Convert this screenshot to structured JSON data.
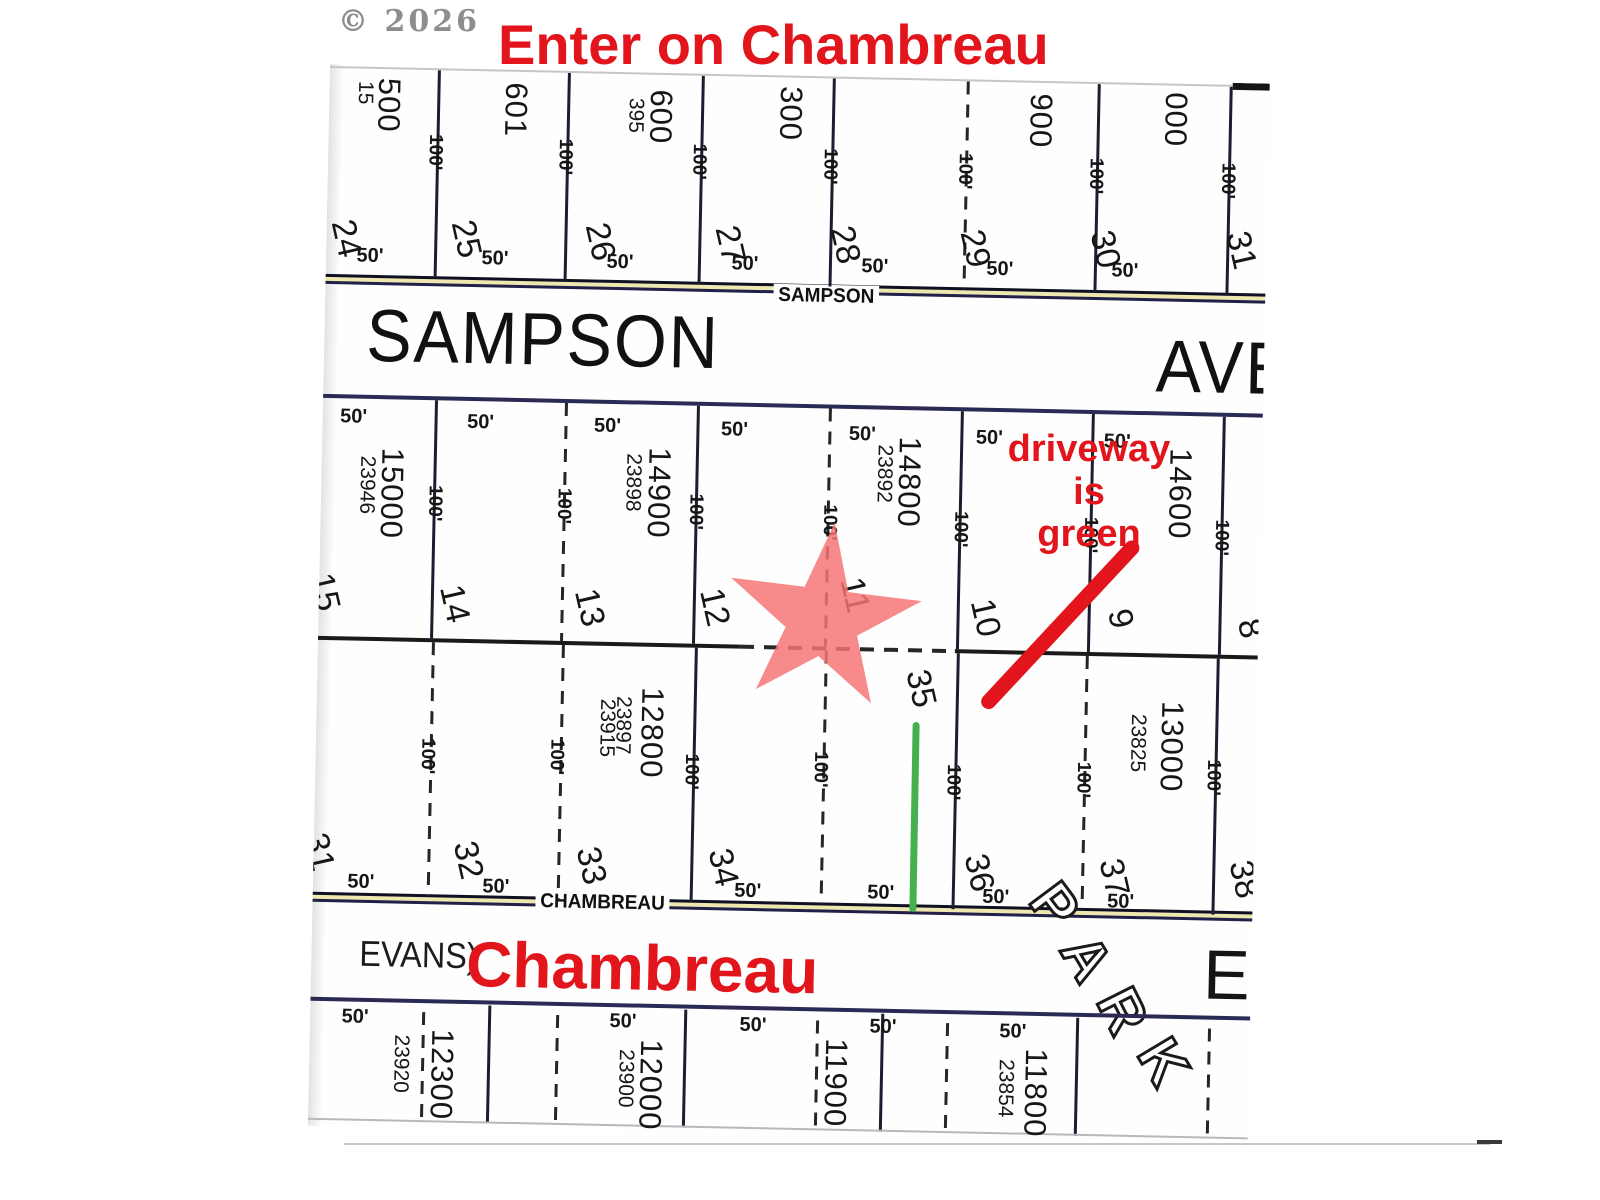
{
  "colors": {
    "annotation_red": "#e1151b",
    "star_fill": "#f57373",
    "driveway_green": "#45b14e",
    "street_fill": "#eee7b0"
  },
  "watermark": "© 2026",
  "annotations": {
    "top_note": "Enter on Chambreau",
    "driveway_note_line1": "driveway is",
    "driveway_note_line2": "green",
    "star_icon": "location-star",
    "arrow_icon": "red-arrow",
    "driveway_line_icon": "green-driveway-line"
  },
  "streets": {
    "sampson": {
      "small": "SAMPSON",
      "large": "SAMPSON",
      "ave": "AVE"
    },
    "chambreau": {
      "small": "CHAMBREAU",
      "evans": "EVANS)",
      "large": "Chambreau",
      "e": "E",
      "park_letters": [
        "P",
        "A",
        "R",
        "K"
      ]
    }
  },
  "plat": {
    "vlines": [
      {
        "x": 108,
        "y1": 4,
        "y2": 212
      },
      {
        "x": 238,
        "y1": 4,
        "y2": 212
      },
      {
        "x": 372,
        "y1": 4,
        "y2": 212
      },
      {
        "x": 503,
        "y1": 4,
        "y2": 212
      },
      {
        "x": 637,
        "y1": 4,
        "y2": 212,
        "d": 1
      },
      {
        "x": 768,
        "y1": 4,
        "y2": 212
      },
      {
        "x": 900,
        "y1": 4,
        "y2": 212
      },
      {
        "x": 112,
        "y1": 334,
        "y2": 572
      },
      {
        "x": 242,
        "y1": 334,
        "y2": 572,
        "d": 1
      },
      {
        "x": 374,
        "y1": 334,
        "y2": 572
      },
      {
        "x": 506,
        "y1": 334,
        "y2": 572,
        "d": 1
      },
      {
        "x": 638,
        "y1": 334,
        "y2": 572
      },
      {
        "x": 769,
        "y1": 334,
        "y2": 572
      },
      {
        "x": 900,
        "y1": 334,
        "y2": 572
      },
      {
        "x": 114,
        "y1": 576,
        "y2": 830,
        "d": 1
      },
      {
        "x": 244,
        "y1": 576,
        "y2": 830,
        "d": 1
      },
      {
        "x": 377,
        "y1": 576,
        "y2": 830
      },
      {
        "x": 507,
        "y1": 576,
        "y2": 830,
        "d": 1
      },
      {
        "x": 639,
        "y1": 576,
        "y2": 832
      },
      {
        "x": 768,
        "y1": 576,
        "y2": 830,
        "d": 1
      },
      {
        "x": 899,
        "y1": 576,
        "y2": 832
      },
      {
        "x": 112,
        "y1": 946,
        "y2": 1052,
        "d": 1
      },
      {
        "x": 178,
        "y1": 938,
        "y2": 1056
      },
      {
        "x": 246,
        "y1": 946,
        "y2": 1052,
        "d": 1
      },
      {
        "x": 374,
        "y1": 938,
        "y2": 1056
      },
      {
        "x": 506,
        "y1": 946,
        "y2": 1052,
        "d": 1
      },
      {
        "x": 571,
        "y1": 938,
        "y2": 1056
      },
      {
        "x": 636,
        "y1": 946,
        "y2": 1052,
        "d": 1
      },
      {
        "x": 766,
        "y1": 938,
        "y2": 1056
      },
      {
        "x": 898,
        "y1": 946,
        "y2": 1052,
        "d": 1
      }
    ],
    "hlines": [
      {
        "x": 0,
        "y": 2,
        "w": 940,
        "h": 2,
        "c": "#c6c6c6"
      },
      {
        "x": 903,
        "y": 0,
        "w": 37,
        "h": 7,
        "c": "#151515"
      },
      {
        "x": 0,
        "y": 330,
        "w": 940,
        "h": 4,
        "c": "#2a2a55"
      },
      {
        "x": 0,
        "y": 572,
        "w": 422,
        "h": 4,
        "c": "#1a1a1a"
      },
      {
        "x": 422,
        "y": 572,
        "w": 217,
        "h": 4,
        "c": "#1a1a1a",
        "d": 1
      },
      {
        "x": 637,
        "y": 572,
        "w": 303,
        "h": 4,
        "c": "#1a1a1a"
      },
      {
        "x": 0,
        "y": 933,
        "w": 940,
        "h": 4,
        "c": "#2a2a55"
      },
      {
        "x": 0,
        "y": 1054,
        "w": 940,
        "h": 2,
        "c": "#b8b8b8"
      }
    ],
    "labels": [
      {
        "t": "15",
        "x": 36,
        "y": 28,
        "k": "addr-sm"
      },
      {
        "t": "500",
        "x": 60,
        "y": 40,
        "k": "addr"
      },
      {
        "t": "601",
        "x": 187,
        "y": 42,
        "k": "addr"
      },
      {
        "t": "395",
        "x": 307,
        "y": 45,
        "k": "addr-sm"
      },
      {
        "t": "600",
        "x": 332,
        "y": 46,
        "k": "addr"
      },
      {
        "t": "300",
        "x": 462,
        "y": 40,
        "k": "addr"
      },
      {
        "t": "900",
        "x": 712,
        "y": 42,
        "k": "addr"
      },
      {
        "t": "000",
        "x": 847,
        "y": 38,
        "k": "addr"
      },
      {
        "t": "100'",
        "x": 107,
        "y": 86,
        "k": "d100"
      },
      {
        "t": "100'",
        "x": 237,
        "y": 88,
        "k": "d100"
      },
      {
        "t": "100'",
        "x": 371,
        "y": 90,
        "k": "d100"
      },
      {
        "t": "100'",
        "x": 502,
        "y": 92,
        "k": "d100"
      },
      {
        "t": "100'",
        "x": 637,
        "y": 94,
        "k": "d100"
      },
      {
        "t": "100'",
        "x": 768,
        "y": 96,
        "k": "d100"
      },
      {
        "t": "100'",
        "x": 900,
        "y": 98,
        "k": "d100"
      },
      {
        "t": "24",
        "x": 20,
        "y": 174,
        "k": "lot"
      },
      {
        "t": "25",
        "x": 140,
        "y": 172,
        "k": "lot"
      },
      {
        "t": "26",
        "x": 274,
        "y": 172,
        "k": "lot"
      },
      {
        "t": "27",
        "x": 404,
        "y": 172,
        "k": "lot"
      },
      {
        "t": "28",
        "x": 519,
        "y": 170,
        "k": "lot"
      },
      {
        "t": "29",
        "x": 649,
        "y": 171,
        "k": "lot"
      },
      {
        "t": "30",
        "x": 779,
        "y": 169,
        "k": "lot"
      },
      {
        "t": "31",
        "x": 915,
        "y": 167,
        "k": "lot"
      },
      {
        "t": "50'",
        "x": 44,
        "y": 191,
        "k": "d50"
      },
      {
        "t": "50'",
        "x": 169,
        "y": 191,
        "k": "d50"
      },
      {
        "t": "50'",
        "x": 294,
        "y": 192,
        "k": "d50"
      },
      {
        "t": "50'",
        "x": 419,
        "y": 191,
        "k": "d50"
      },
      {
        "t": "50'",
        "x": 549,
        "y": 191,
        "k": "d50"
      },
      {
        "t": "50'",
        "x": 674,
        "y": 191,
        "k": "d50"
      },
      {
        "t": "50'",
        "x": 799,
        "y": 190,
        "k": "d50"
      },
      {
        "t": "50'",
        "x": 31,
        "y": 352,
        "k": "d50"
      },
      {
        "t": "50'",
        "x": 158,
        "y": 355,
        "k": "d50"
      },
      {
        "t": "50'",
        "x": 285,
        "y": 356,
        "k": "d50"
      },
      {
        "t": "50'",
        "x": 412,
        "y": 357,
        "k": "d50"
      },
      {
        "t": "50'",
        "x": 540,
        "y": 359,
        "k": "d50"
      },
      {
        "t": "50'",
        "x": 667,
        "y": 360,
        "k": "d50"
      },
      {
        "t": "50'",
        "x": 795,
        "y": 361,
        "k": "d50"
      },
      {
        "t": "23946",
        "x": 46,
        "y": 420,
        "k": "addr-sm"
      },
      {
        "t": "15000",
        "x": 71,
        "y": 428,
        "k": "addr"
      },
      {
        "t": "23898",
        "x": 312,
        "y": 412,
        "k": "addr-sm"
      },
      {
        "t": "14900",
        "x": 338,
        "y": 422,
        "k": "addr"
      },
      {
        "t": "23892",
        "x": 563,
        "y": 398,
        "k": "addr-sm"
      },
      {
        "t": "14800",
        "x": 588,
        "y": 406,
        "k": "addr"
      },
      {
        "t": "14600",
        "x": 859,
        "y": 412,
        "k": "addr"
      },
      {
        "t": "100'",
        "x": 114,
        "y": 437,
        "k": "d100"
      },
      {
        "t": "100'",
        "x": 243,
        "y": 437,
        "k": "d100"
      },
      {
        "t": "100'",
        "x": 375,
        "y": 440,
        "k": "d100"
      },
      {
        "t": "100'",
        "x": 509,
        "y": 448,
        "k": "d100"
      },
      {
        "t": "100'",
        "x": 640,
        "y": 452,
        "k": "d100"
      },
      {
        "t": "100'",
        "x": 770,
        "y": 455,
        "k": "d100"
      },
      {
        "t": "100'",
        "x": 901,
        "y": 455,
        "k": "d100"
      },
      {
        "t": "15",
        "x": 6,
        "y": 528,
        "k": "lot"
      },
      {
        "t": "14",
        "x": 136,
        "y": 537,
        "k": "lot"
      },
      {
        "t": "13",
        "x": 271,
        "y": 538,
        "k": "lot"
      },
      {
        "t": "12",
        "x": 396,
        "y": 535,
        "k": "lot"
      },
      {
        "t": "11",
        "x": 536,
        "y": 520,
        "k": "lot"
      },
      {
        "t": "10",
        "x": 667,
        "y": 540,
        "k": "lot"
      },
      {
        "t": "9",
        "x": 802,
        "y": 538,
        "k": "lot"
      },
      {
        "t": "8",
        "x": 932,
        "y": 545,
        "k": "lot"
      },
      {
        "t": "23915",
        "x": 291,
        "y": 658,
        "k": "addr-sm"
      },
      {
        "t": "23897",
        "x": 307,
        "y": 655,
        "k": "addr-sm"
      },
      {
        "t": "12800",
        "x": 336,
        "y": 662,
        "k": "addr"
      },
      {
        "t": "23825",
        "x": 822,
        "y": 662,
        "k": "addr-sm"
      },
      {
        "t": "13000",
        "x": 856,
        "y": 665,
        "k": "addr"
      },
      {
        "t": "35",
        "x": 604,
        "y": 612,
        "k": "lot"
      },
      {
        "t": "100'",
        "x": 112,
        "y": 690,
        "k": "d100"
      },
      {
        "t": "100'",
        "x": 241,
        "y": 688,
        "k": "d100"
      },
      {
        "t": "100'",
        "x": 376,
        "y": 700,
        "k": "d100"
      },
      {
        "t": "100'",
        "x": 505,
        "y": 695,
        "k": "d100"
      },
      {
        "t": "100'",
        "x": 638,
        "y": 705,
        "k": "d100"
      },
      {
        "t": "100'",
        "x": 768,
        "y": 700,
        "k": "d100"
      },
      {
        "t": "100'",
        "x": 898,
        "y": 695,
        "k": "d100"
      },
      {
        "t": "31",
        "x": 6,
        "y": 788,
        "k": "lot"
      },
      {
        "t": "32",
        "x": 155,
        "y": 793,
        "k": "lot"
      },
      {
        "t": "33",
        "x": 278,
        "y": 796,
        "k": "lot"
      },
      {
        "t": "34",
        "x": 410,
        "y": 795,
        "k": "lot"
      },
      {
        "t": "36",
        "x": 666,
        "y": 795,
        "k": "lot"
      },
      {
        "t": "37",
        "x": 801,
        "y": 797,
        "k": "lot"
      },
      {
        "t": "38",
        "x": 931,
        "y": 796,
        "k": "lot"
      },
      {
        "t": "50'",
        "x": 48,
        "y": 817,
        "k": "d50"
      },
      {
        "t": "50'",
        "x": 183,
        "y": 819,
        "k": "d50"
      },
      {
        "t": "50'",
        "x": 435,
        "y": 818,
        "k": "d50"
      },
      {
        "t": "50'",
        "x": 568,
        "y": 817,
        "k": "d50"
      },
      {
        "t": "50'",
        "x": 683,
        "y": 819,
        "k": "d50"
      },
      {
        "t": "50'",
        "x": 808,
        "y": 821,
        "k": "d50"
      },
      {
        "t": "50'",
        "x": 45,
        "y": 952,
        "k": "d50"
      },
      {
        "t": "50'",
        "x": 313,
        "y": 951,
        "k": "d50"
      },
      {
        "t": "50'",
        "x": 443,
        "y": 952,
        "k": "d50"
      },
      {
        "t": "50'",
        "x": 573,
        "y": 951,
        "k": "d50"
      },
      {
        "t": "50'",
        "x": 703,
        "y": 953,
        "k": "d50"
      },
      {
        "t": "23920",
        "x": 92,
        "y": 998,
        "k": "addr-sm"
      },
      {
        "t": "12300",
        "x": 133,
        "y": 1008,
        "k": "addr"
      },
      {
        "t": "23900",
        "x": 317,
        "y": 1008,
        "k": "addr-sm"
      },
      {
        "t": "12000",
        "x": 342,
        "y": 1014,
        "k": "addr"
      },
      {
        "t": "11900",
        "x": 527,
        "y": 1008,
        "k": "addr"
      },
      {
        "t": "23854",
        "x": 697,
        "y": 1010,
        "k": "addr-sm"
      },
      {
        "t": "11800",
        "x": 727,
        "y": 1014,
        "k": "addr"
      }
    ]
  }
}
